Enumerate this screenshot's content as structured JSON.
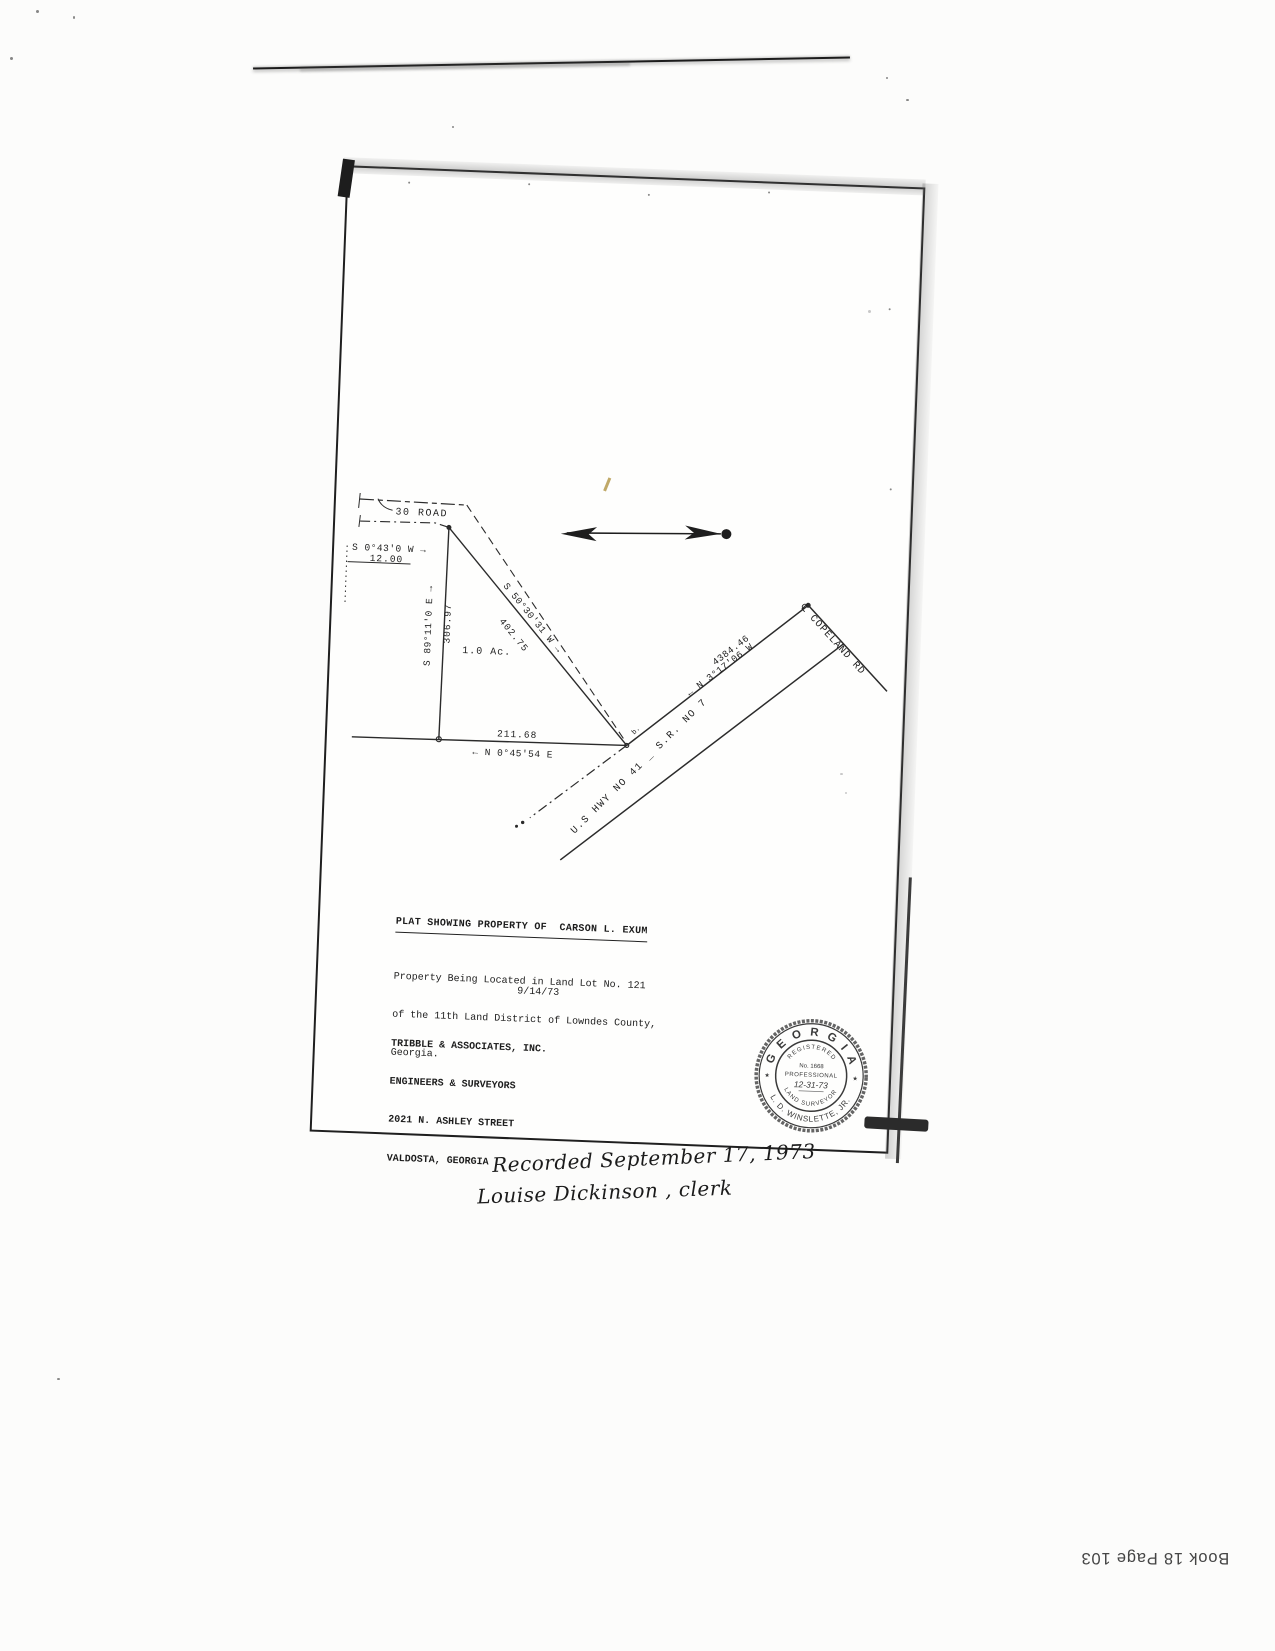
{
  "document": {
    "book_page": "Book 18 Page 103"
  },
  "plat": {
    "title": "PLAT SHOWING PROPERTY OF  CARSON L. EXUM",
    "description_lines": [
      "Property Being Located in Land Lot No. 121",
      "of the 11th Land District of Lowndes County,",
      "Georgia."
    ],
    "date": "9/14/73",
    "firm_lines": [
      "TRIBBLE & ASSOCIATES, INC.",
      "ENGINEERS & SURVEYORS",
      "2021 N. ASHLEY STREET",
      "VALDOSTA, GEORGIA"
    ],
    "labels": {
      "road_top": "30 ROAD",
      "bearing_west": "S 0°43'0 W →",
      "dist_west": "12.00",
      "bearing_north_line": "S 89°11'0 E →",
      "dist_north_line": "306.97",
      "area": "1.0 Ac.",
      "bearing_diag": "S 50°30'31 W →",
      "dist_diag": "402.75",
      "dist_south": "211.68",
      "bearing_south": "← N 0°45'54 E",
      "dist_tie": "4384.46",
      "bearing_tie": "← N 3°17'06 W",
      "highway": "U.S HWY NO 41 _ S.R. NO 7",
      "copeland": "℄ COPELAND RD",
      "point": "b."
    },
    "seal": {
      "state": "G E O R G I A",
      "registered": "REGISTERED",
      "number": "No. 1668",
      "professional": "PROFESSIONAL",
      "date_hand": "12-31-73",
      "land_surveyor": "LAND SURVEYOR",
      "name": "L. D. WINSLETTE, JR.",
      "star": "★"
    }
  },
  "handwriting": {
    "line1": "Recorded September 17, 1973",
    "line2": "Louise Dickinson , clerk"
  }
}
